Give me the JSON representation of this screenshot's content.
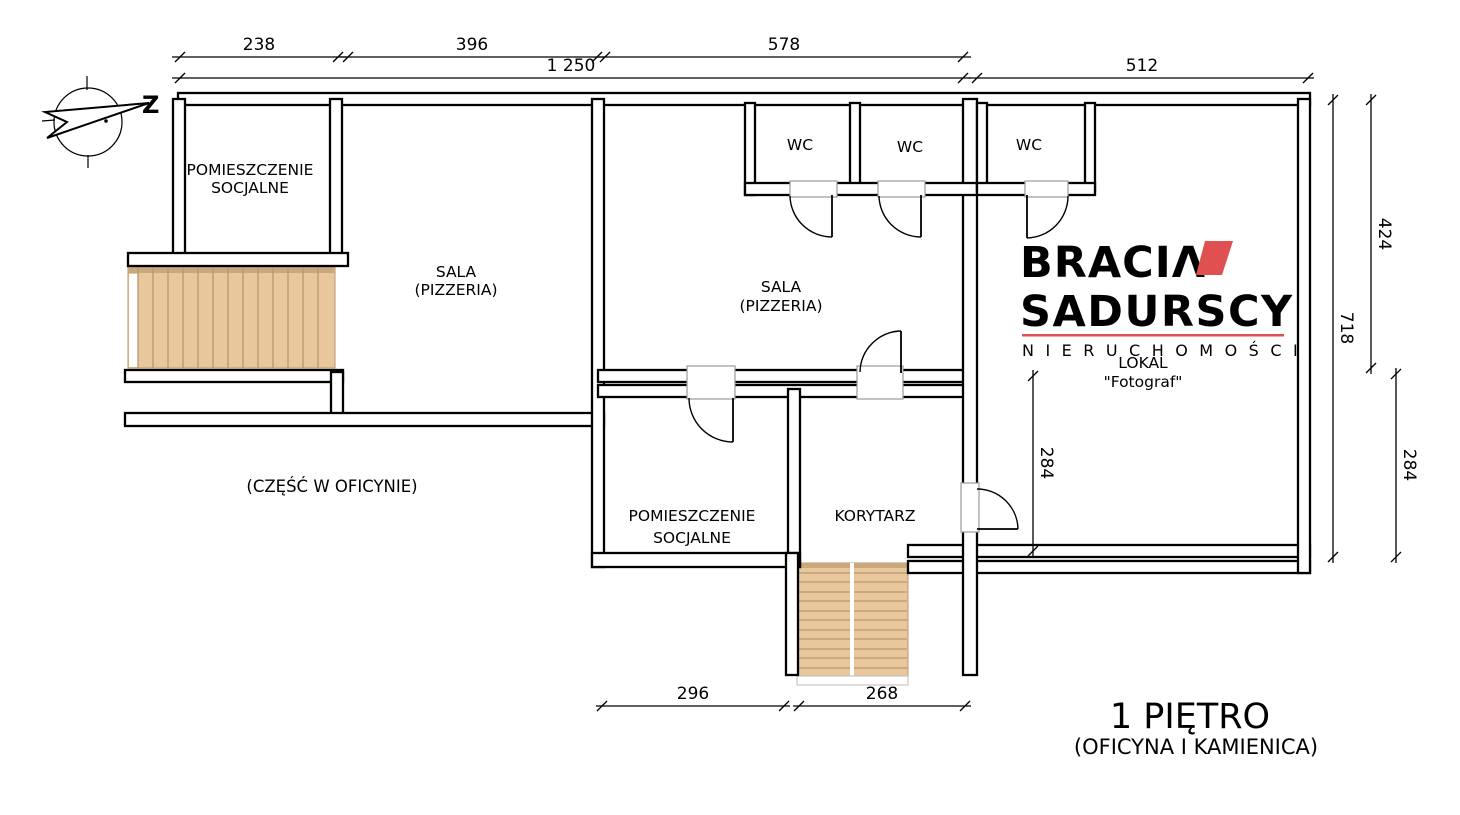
{
  "colors": {
    "wall": "#000000",
    "wood": "#e8c79d",
    "wood_band": "#c9a87c",
    "wood_line": "#b8976e",
    "door_frame": "#9a9a9a",
    "logo_gray": "#4e4f54",
    "logo_red": "#e05050",
    "background": "#ffffff"
  },
  "compass": {
    "label": "Z"
  },
  "rooms": {
    "ps1": {
      "lines": [
        "POMIESZCZENIE",
        "SOCJALNE"
      ]
    },
    "sala1": {
      "lines": [
        "SALA",
        "(PIZZERIA)"
      ]
    },
    "sala2": {
      "lines": [
        "SALA",
        "(PIZZERIA)"
      ]
    },
    "wc1": {
      "label": "WC"
    },
    "wc2": {
      "label": "WC"
    },
    "wc3": {
      "label": "WC"
    },
    "ps2": {
      "lines": [
        "POMIESZCZENIE",
        "SOCJALNE"
      ]
    },
    "korytarz": {
      "label": "KORYTARZ"
    },
    "lokal": {
      "lines": [
        "LOKAL",
        "\"Fotograf\""
      ]
    },
    "oficyna_note": {
      "label": "(CZĘŚĆ W OFICYNIE)"
    }
  },
  "dims": {
    "d238": "238",
    "d396": "396",
    "d578": "578",
    "d1250": "1 250",
    "d512": "512",
    "d424": "424",
    "d718": "718",
    "d284_right": "284",
    "d284_inner": "284",
    "d296": "296",
    "d268": "268"
  },
  "logo": {
    "brand_top": "BRACIΛ",
    "brand_bottom": "SADURSCY",
    "tagline": "N I E R U C H O M O Ś C I"
  },
  "title": {
    "main": "1 PIĘTRO",
    "sub": "(OFICYNA I KAMIENICA)"
  }
}
